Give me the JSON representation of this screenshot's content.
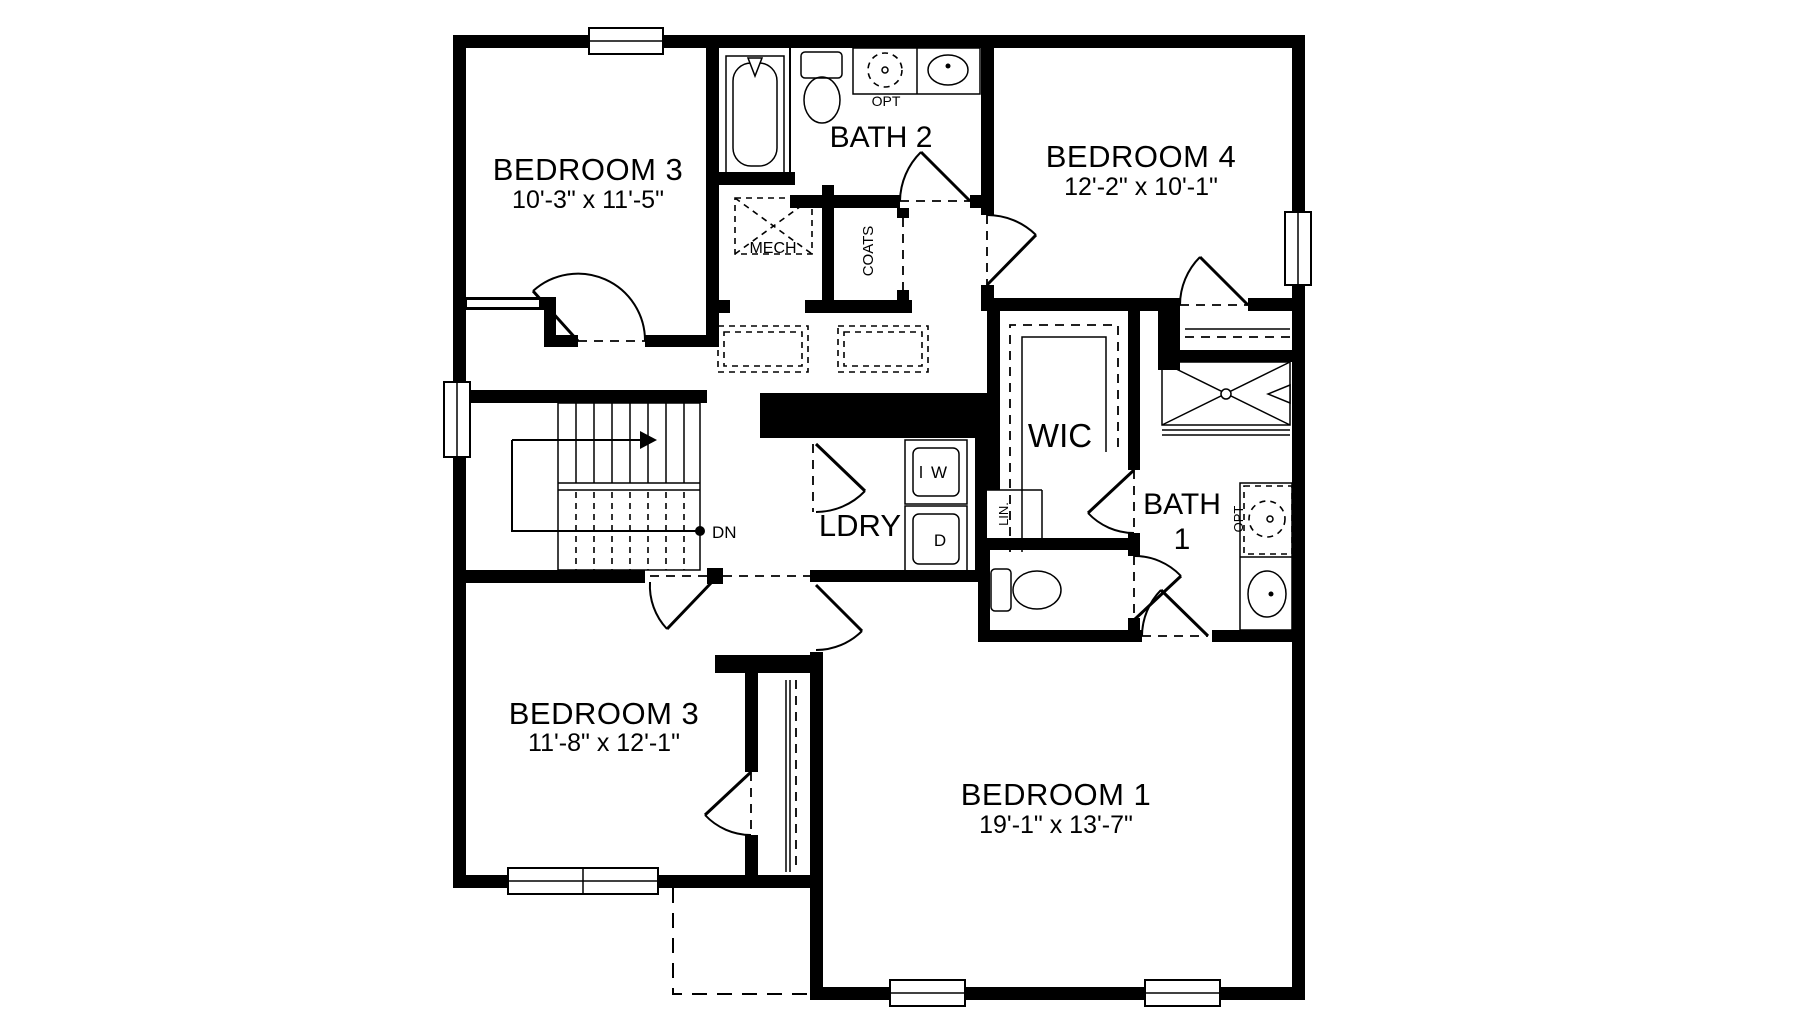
{
  "plan": {
    "rooms": [
      {
        "name": "BEDROOM 3",
        "dims": "10'-3\" x 11'-5\""
      },
      {
        "name": "BATH 2"
      },
      {
        "name": "BEDROOM 4",
        "dims": "12'-2\" x 10'-1\""
      },
      {
        "name": "MECH"
      },
      {
        "name": "COATS"
      },
      {
        "name": "WIC"
      },
      {
        "name": "LDRY"
      },
      {
        "name": "LIN."
      },
      {
        "name": "BATH",
        "line2": "1"
      },
      {
        "name": "BEDROOM 3",
        "dims": "11'-8\" x 12'-1\""
      },
      {
        "name": "BEDROOM 1",
        "dims": "19'-1\" x 13'-7\""
      }
    ],
    "annotations": {
      "opt": "OPT",
      "dn": "DN",
      "washer": "W",
      "dryer": "D"
    },
    "colors": {
      "wall": "#000000",
      "background": "#ffffff"
    }
  }
}
